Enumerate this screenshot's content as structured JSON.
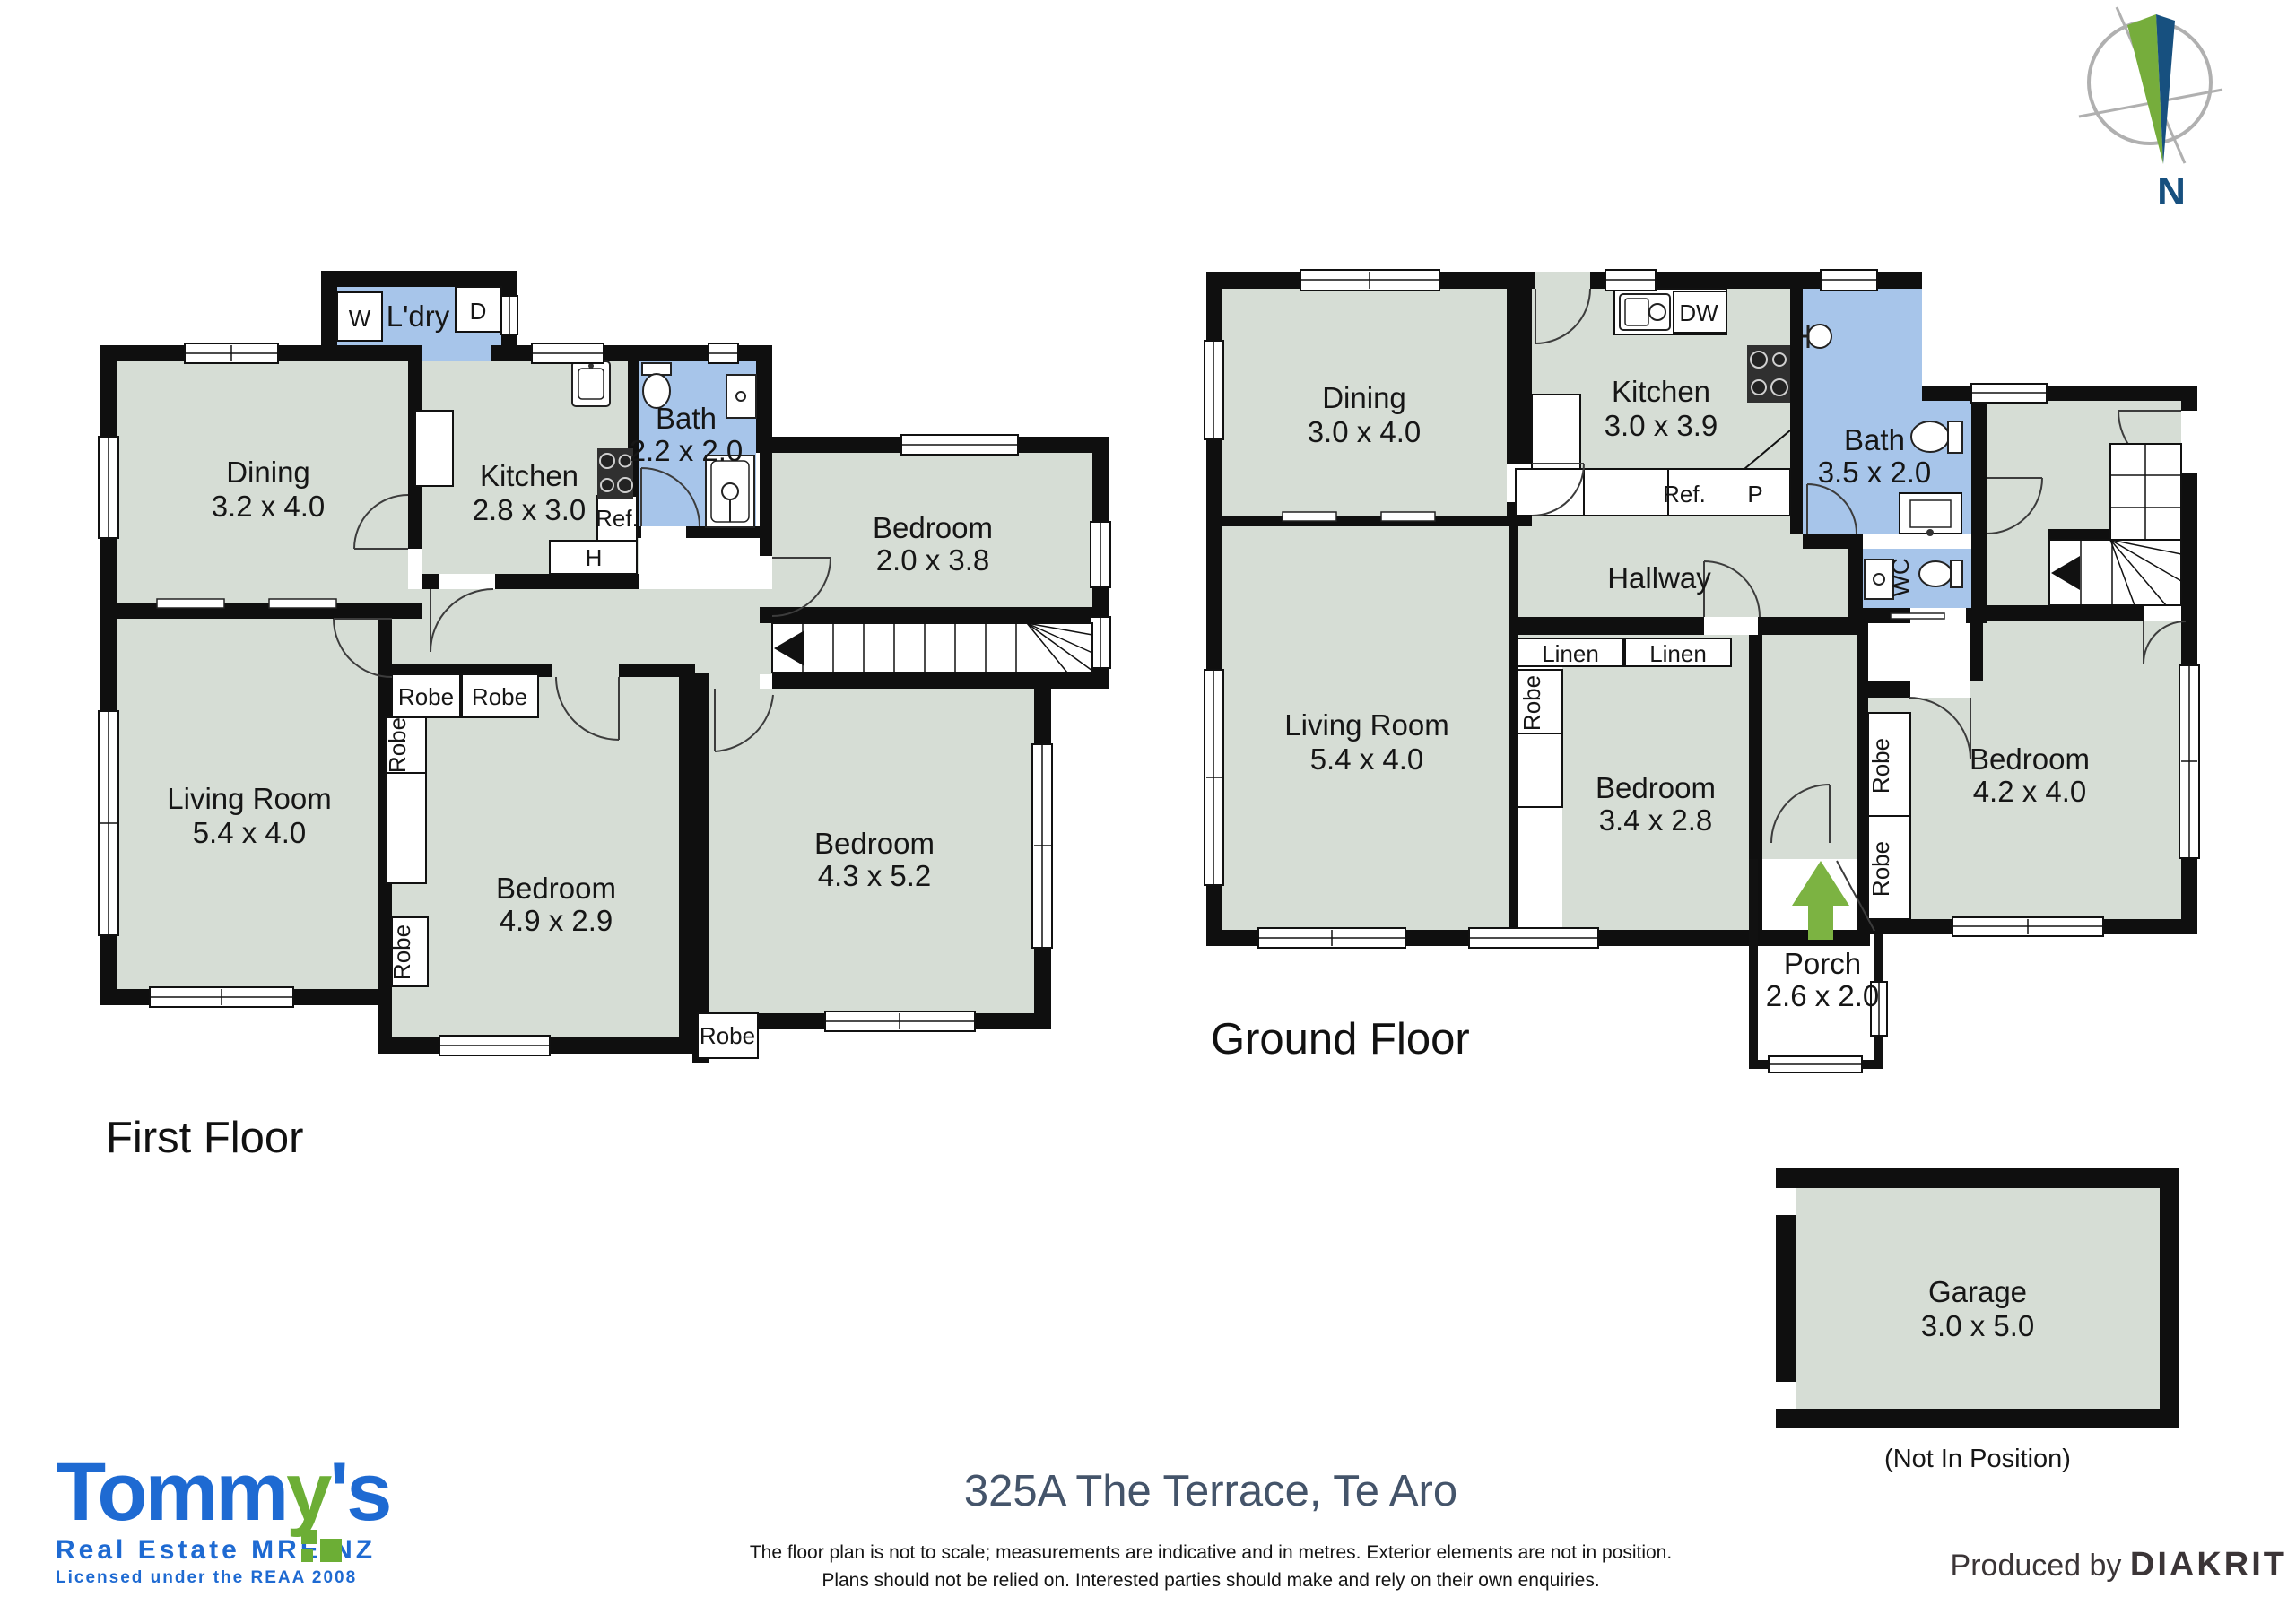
{
  "page": {
    "address": "325A The Terrace, Te Aro",
    "disclaimer_line1": "The floor plan is not to scale; measurements are indicative and in metres. Exterior elements are not in position.",
    "disclaimer_line2": "Plans should not be relied on. Interested parties should make and rely on their own enquiries.",
    "produced_by_prefix": "Produced by",
    "produced_by_brand": "DIAKRIT"
  },
  "branding": {
    "logo_part1": "Tomm",
    "logo_part2": "y",
    "logo_part3": "'s",
    "logo_sub1": "Real Estate MREINZ",
    "logo_sub2": "Licensed under the REAA 2008",
    "blue": "#1e6ad2",
    "green": "#6cae35"
  },
  "compass": {
    "label": "N",
    "needle_green": "#76ad3c",
    "needle_navy": "#17507f"
  },
  "colors": {
    "room_fill": "#d6ddd5",
    "wet_room_fill": "#a7c5ea",
    "wall": "#0f0f0f",
    "entry_arrow_green": "#7cb342"
  },
  "first_floor": {
    "label": "First Floor",
    "rooms": {
      "dining": {
        "name": "Dining",
        "dims": "3.2 x 4.0"
      },
      "kitchen": {
        "name": "Kitchen",
        "dims": "2.8 x 3.0"
      },
      "laundry": {
        "name": "L'dry"
      },
      "bath": {
        "name": "Bath",
        "dims": "2.2 x 2.0"
      },
      "bedroom_top": {
        "name": "Bedroom",
        "dims": "2.0 x 3.8"
      },
      "living": {
        "name": "Living Room",
        "dims": "5.4 x 4.0"
      },
      "bedroom_mid": {
        "name": "Bedroom",
        "dims": "4.9 x 2.9"
      },
      "bedroom_right": {
        "name": "Bedroom",
        "dims": "4.3 x 5.2"
      }
    },
    "fixtures": {
      "washer": "W",
      "dryer": "D",
      "fridge": "Ref.",
      "hot_water": "H",
      "robe": "Robe"
    }
  },
  "ground_floor": {
    "label": "Ground Floor",
    "rooms": {
      "dining": {
        "name": "Dining",
        "dims": "3.0 x 4.0"
      },
      "kitchen": {
        "name": "Kitchen",
        "dims": "3.0 x 3.9"
      },
      "bath": {
        "name": "Bath",
        "dims": "3.5 x 2.0"
      },
      "wc": {
        "name": "WC"
      },
      "hallway": {
        "name": "Hallway"
      },
      "living": {
        "name": "Living Room",
        "dims": "5.4 x 4.0"
      },
      "bedroom_mid": {
        "name": "Bedroom",
        "dims": "3.4 x 2.8"
      },
      "bedroom_right": {
        "name": "Bedroom",
        "dims": "4.2 x 4.0"
      },
      "porch": {
        "name": "Porch",
        "dims": "2.6 x 2.0"
      }
    },
    "fixtures": {
      "dishwasher": "DW",
      "fridge": "Ref.",
      "pantry": "P",
      "linen": "Linen",
      "robe": "Robe"
    }
  },
  "garage": {
    "name": "Garage",
    "dims": "3.0 x 5.0",
    "caption": "(Not In Position)"
  }
}
